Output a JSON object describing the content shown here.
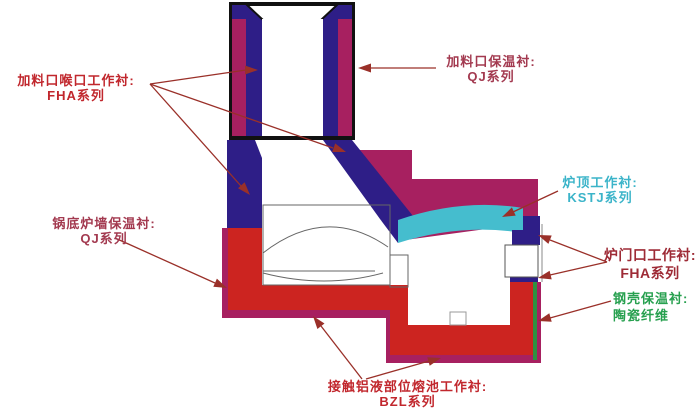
{
  "diagram": {
    "description": "Furnace lining cross-section diagram with callout labels",
    "labels": {
      "feed_throat": {
        "line1": "加料口喉口工作衬:",
        "line2": "FHA系列"
      },
      "feed_insulation": {
        "line1": "加料口保温衬:",
        "line2": "QJ系列"
      },
      "roof_work": {
        "line1": "炉顶工作衬:",
        "line2": "KSTJ系列"
      },
      "pot_wall_insulation": {
        "line1": "锅底炉墙保温衬:",
        "line2": "QJ系列"
      },
      "door_work": {
        "line1": "炉门口工作衬:",
        "line2": "FHA系列"
      },
      "shell_insulation": {
        "line1": "钢壳保温衬:",
        "line2": "陶瓷纤维"
      },
      "melt_pool_work": {
        "line1": "接触铝液部位熔池工作衬:",
        "line2": "BZL系列"
      }
    },
    "colors": {
      "navy": "#2E1E87",
      "magenta": "#A72060",
      "red": "#CC2420",
      "cyan": "#45BDCE",
      "green": "#2E9241",
      "arrow": "#9A3029",
      "outline": "#666666",
      "border_black": "#111111",
      "label_red": "#C1272D",
      "label_maroon": "#A33A50",
      "label_dark_red": "#9E2B36",
      "label_cyan": "#3BB4C9",
      "label_green": "#27A04F"
    }
  }
}
